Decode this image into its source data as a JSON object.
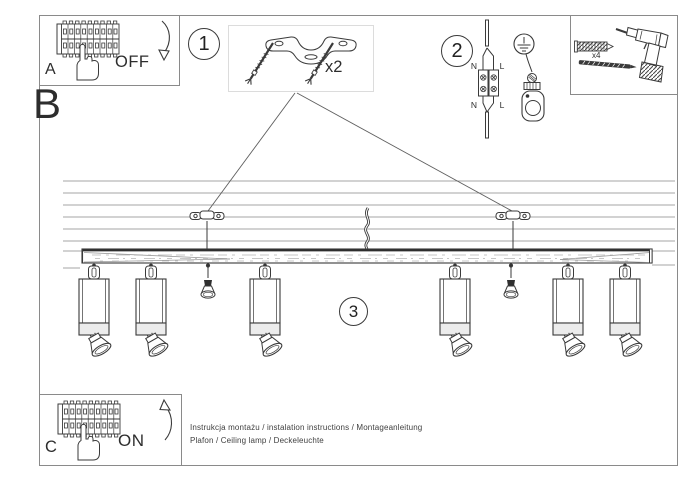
{
  "sheet": {
    "section_a": {
      "label": "A",
      "action": "OFF"
    },
    "section_b": {
      "label": "B"
    },
    "section_c": {
      "label": "C",
      "action": "ON"
    },
    "step1": {
      "number": "1",
      "quantity": "x2"
    },
    "step2": {
      "number": "2",
      "terminals": {
        "top_left": "N",
        "top_right": "L",
        "bottom_left": "N",
        "bottom_right": "L"
      }
    },
    "step3": {
      "number": "3"
    },
    "hardware": {
      "anchor_quantity": "x4"
    },
    "footer": {
      "line1": "Instrukcja montażu / instalation instructions / Montageanleitung",
      "line2": "Plafon / Ceiling lamp / Deckeleuchte"
    },
    "colors": {
      "ink": "#3a3a3a",
      "frame": "#8a8a8a"
    }
  }
}
